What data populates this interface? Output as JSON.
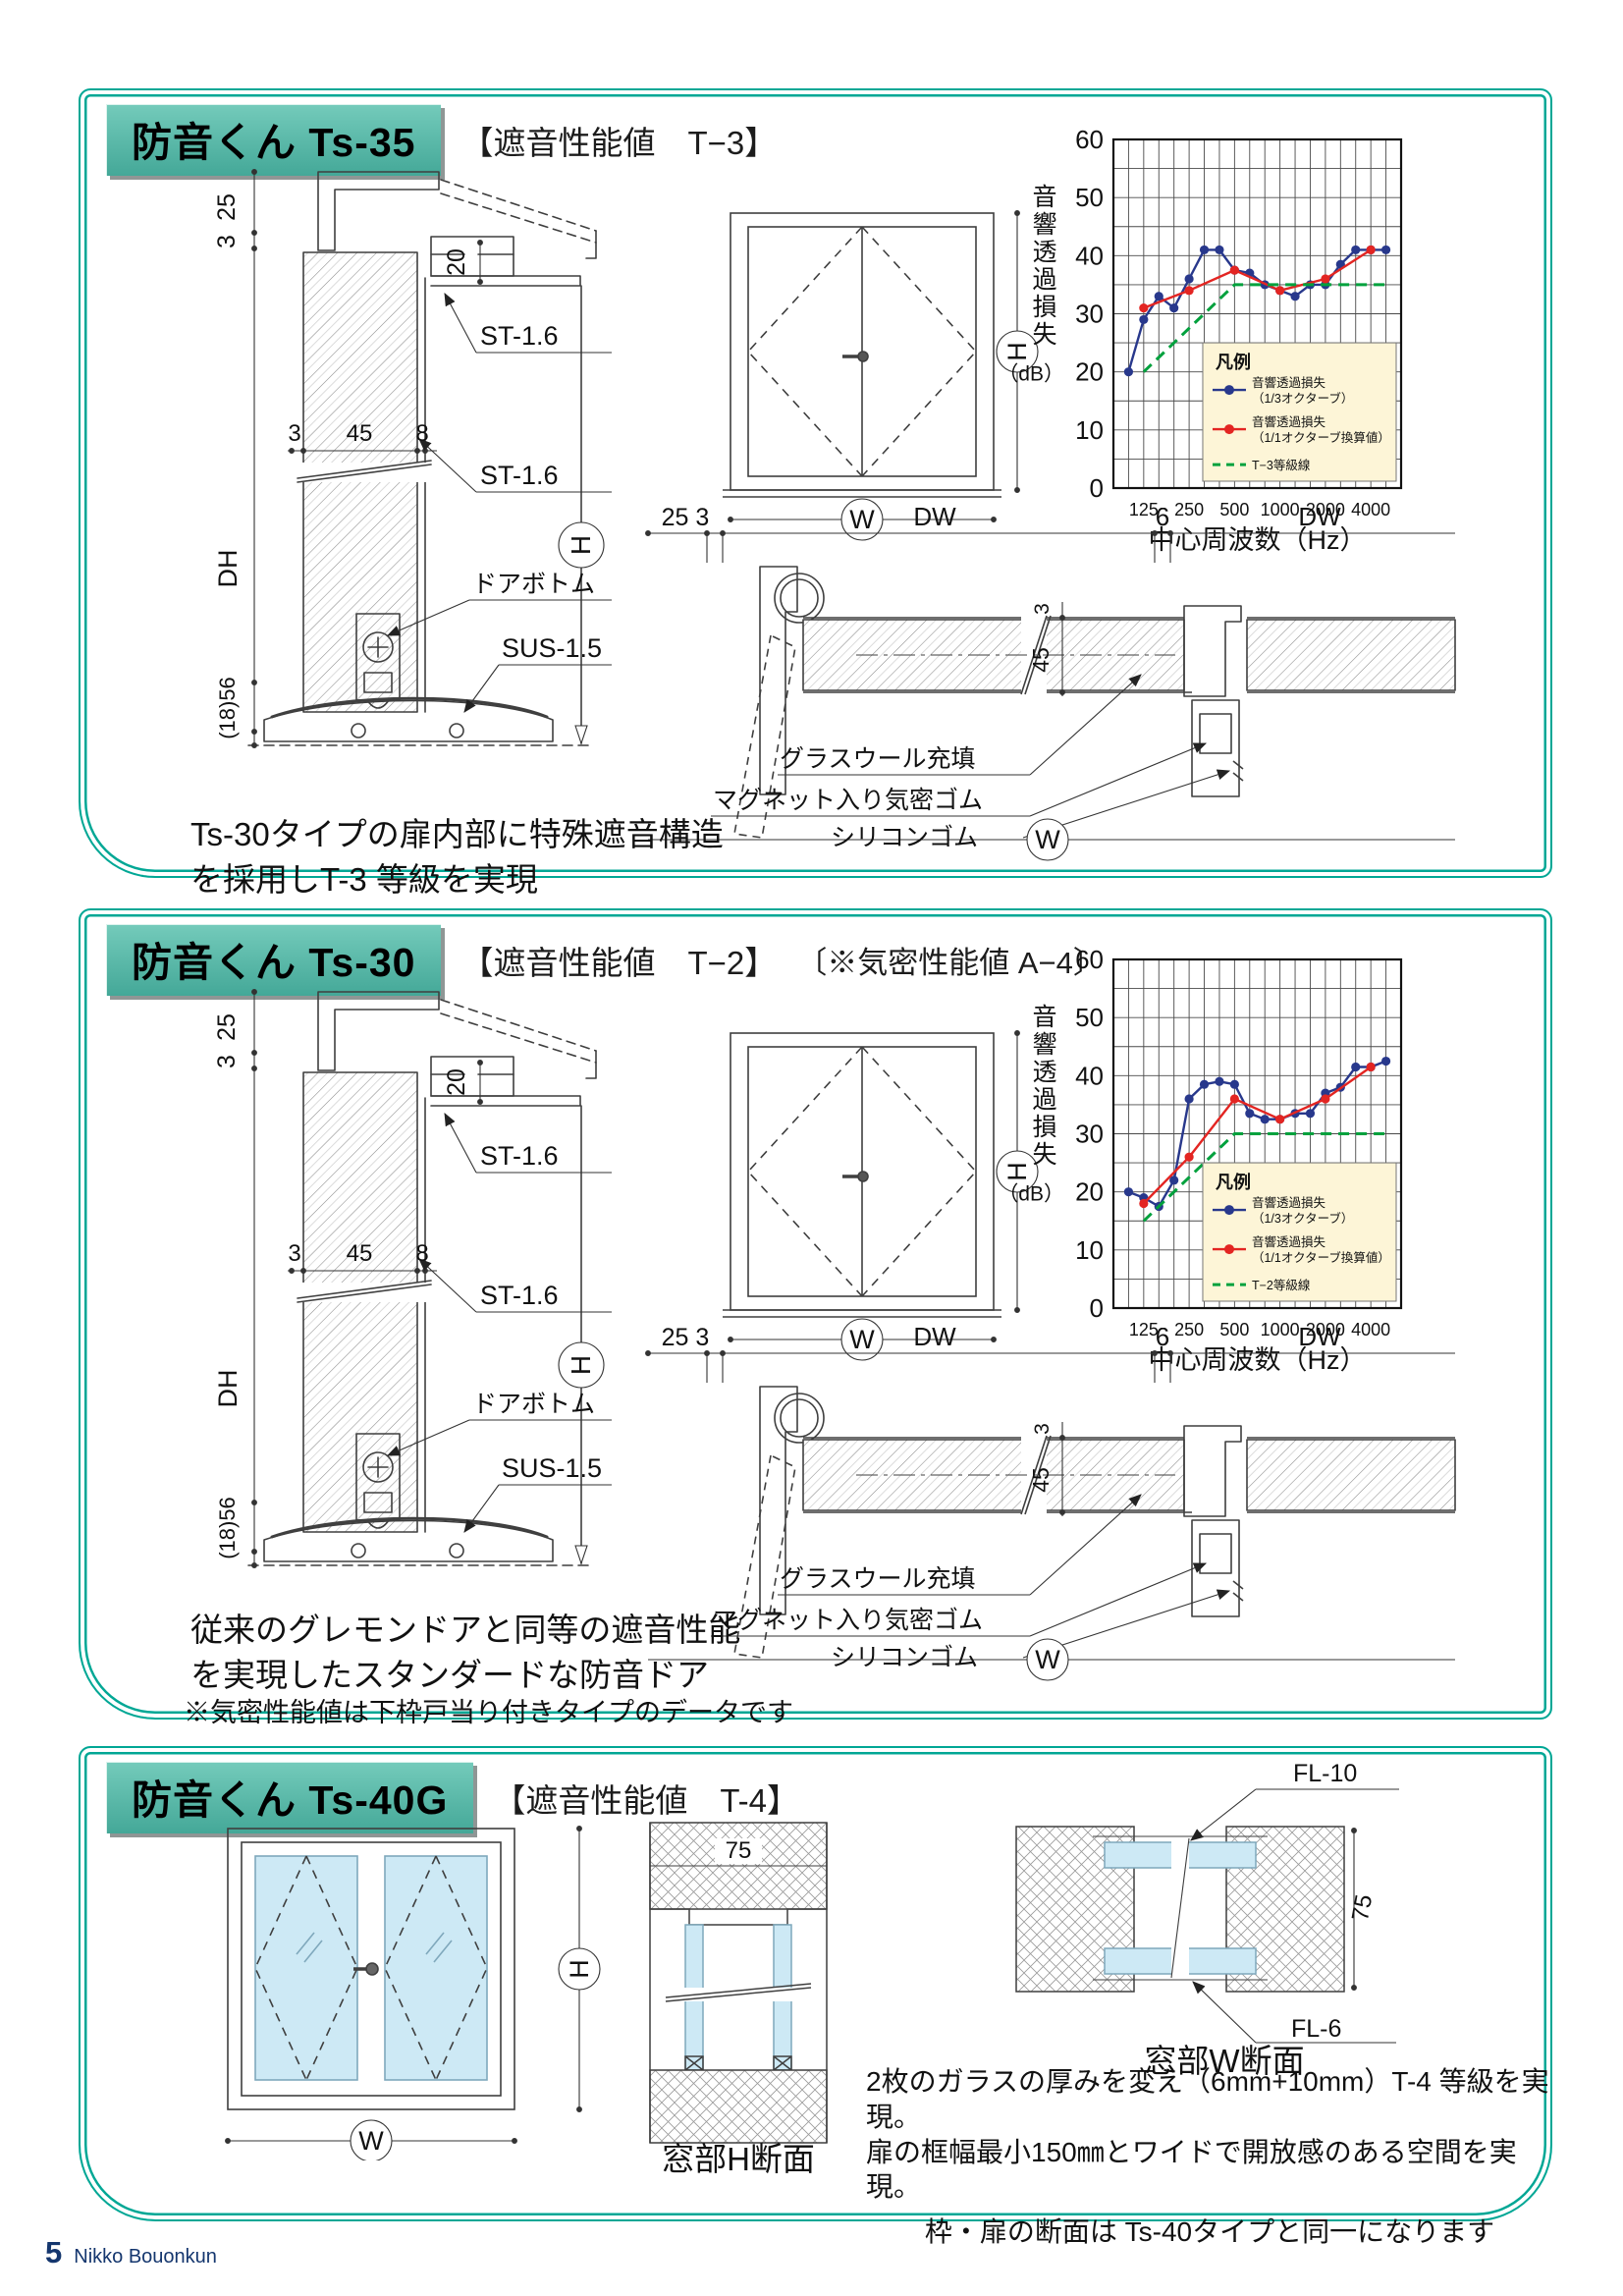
{
  "page": {
    "number": "5",
    "brand": "Nikko Bouonkun"
  },
  "colors": {
    "teal_border": "#00a795",
    "header_top": "#74cbbb",
    "header_bottom": "#44a898",
    "header_shadow": "#8f9695",
    "blue": "#28388c",
    "red": "#e32522",
    "green": "#00a13d",
    "legend_bg": "#fdf5d7",
    "glass": "#cde9f5",
    "footer_navy": "#14366e"
  },
  "sections": {
    "ts35": {
      "title": "防音くん Ts-35",
      "subtitle": "【遮音性能値　T−3】",
      "caption1": "Ts-30タイプの扉内部に特殊遮音構造",
      "caption2": "を採用しT-3 等級を実現"
    },
    "ts30": {
      "title": "防音くん Ts-30",
      "subtitle": "【遮音性能値　T−2】",
      "subtitle2": "〔※気密性能値 A−4〕",
      "caption1": "従来のグレモンドアと同等の遮音性能",
      "caption2": "を実現したスタンダードな防音ドア",
      "note": "※気密性能値は下枠戸当り付きタイプのデータです"
    },
    "ts40g": {
      "title": "防音くん Ts-40G",
      "subtitle": "【遮音性能値　T-4】",
      "fl10": "FL-10",
      "fl6": "FL-6",
      "dim75": "75",
      "h_caption": "窓部H断面",
      "w_caption": "窓部W断面",
      "caption1": "2枚のガラスの厚みを変え（6mm+10mm）T-4 等級を実現。",
      "caption2": "扉の框幅最小150㎜とワイドで開放感のある空間を実現。",
      "caption3": "枠・扉の断面は Ts-40タイプと同一になります"
    }
  },
  "drawing": {
    "dim25": "25",
    "dim3": "3",
    "dim20": "20",
    "dim45": "45",
    "dim8": "8",
    "dh": "DH",
    "dim1856": "(18)56",
    "h": "H",
    "w": "W",
    "st16": "ST-1.6",
    "doorbottom": "ドアボトム",
    "sus15": "SUS-1.5",
    "hdim253": "25 3",
    "dw": "DW",
    "dim6": "6",
    "glasswool": "グラスウール充填",
    "magnet": "マグネット入り気密ゴム",
    "silicone": "シリコンゴム"
  },
  "chart_data": [
    {
      "type": "line",
      "xlabel": "中心周波数（Hz）",
      "ylabel_vertical": "音響透過損失",
      "ylabel_unit": "（dB）",
      "ylim": [
        0,
        60
      ],
      "ytick_step": 10,
      "grid_db_step": 5,
      "origin_label": "0",
      "freqs": [
        100,
        125,
        160,
        200,
        250,
        315,
        400,
        500,
        630,
        800,
        1000,
        1250,
        1600,
        2000,
        2500,
        3150,
        4000,
        5000
      ],
      "xticks": [
        125,
        250,
        500,
        1000,
        2000,
        4000
      ],
      "legend_title": "凡例",
      "legend_position": "lower right inside",
      "grid": true,
      "series": [
        {
          "id": "third-octave",
          "color_key": "blue",
          "dashed": false,
          "legend": [
            "音響透過損失",
            "（1/3オクターブ）"
          ],
          "points": [
            [
              100,
              20
            ],
            [
              125,
              29
            ],
            [
              160,
              33
            ],
            [
              200,
              31
            ],
            [
              250,
              36
            ],
            [
              315,
              41
            ],
            [
              400,
              41
            ],
            [
              500,
              37.5
            ],
            [
              630,
              37
            ],
            [
              800,
              35
            ],
            [
              1000,
              34
            ],
            [
              1250,
              33
            ],
            [
              1600,
              35
            ],
            [
              2000,
              35
            ],
            [
              2500,
              38.5
            ],
            [
              3150,
              41
            ],
            [
              4000,
              41
            ],
            [
              5000,
              41
            ]
          ]
        },
        {
          "id": "full-octave",
          "color_key": "red",
          "dashed": false,
          "legend": [
            "音響透過損失",
            "（1/1オクターブ換算値）"
          ],
          "points": [
            [
              125,
              31
            ],
            [
              250,
              34
            ],
            [
              500,
              37.5
            ],
            [
              1000,
              34
            ],
            [
              2000,
              36
            ],
            [
              4000,
              41
            ]
          ]
        },
        {
          "id": "grade-line",
          "color_key": "green",
          "dashed": true,
          "legend": [
            "T−3等級線"
          ],
          "points": [
            [
              125,
              20
            ],
            [
              500,
              35
            ],
            [
              5000,
              35
            ]
          ]
        }
      ]
    },
    {
      "type": "line",
      "xlabel": "中心周波数（Hz）",
      "ylabel_vertical": "音響透過損失",
      "ylabel_unit": "（dB）",
      "ylim": [
        0,
        60
      ],
      "ytick_step": 10,
      "grid_db_step": 5,
      "origin_label": "0",
      "freqs": [
        100,
        125,
        160,
        200,
        250,
        315,
        400,
        500,
        630,
        800,
        1000,
        1250,
        1600,
        2000,
        2500,
        3150,
        4000,
        5000
      ],
      "xticks": [
        125,
        250,
        500,
        1000,
        2000,
        4000
      ],
      "legend_title": "凡例",
      "legend_position": "lower right inside",
      "grid": true,
      "series": [
        {
          "id": "third-octave",
          "color_key": "blue",
          "dashed": false,
          "legend": [
            "音響透過損失",
            "（1/3オクターブ）"
          ],
          "points": [
            [
              100,
              20
            ],
            [
              125,
              19
            ],
            [
              160,
              17.5
            ],
            [
              200,
              22
            ],
            [
              250,
              36
            ],
            [
              315,
              38.5
            ],
            [
              400,
              39
            ],
            [
              500,
              38.5
            ],
            [
              630,
              33.5
            ],
            [
              800,
              32.5
            ],
            [
              1000,
              32.5
            ],
            [
              1250,
              33.5
            ],
            [
              1600,
              33.5
            ],
            [
              2000,
              37
            ],
            [
              2500,
              38
            ],
            [
              3150,
              41.5
            ],
            [
              4000,
              41.5
            ],
            [
              5000,
              42.5
            ]
          ]
        },
        {
          "id": "full-octave",
          "color_key": "red",
          "dashed": false,
          "legend": [
            "音響透過損失",
            "（1/1オクターブ換算値）"
          ],
          "points": [
            [
              125,
              18
            ],
            [
              250,
              26
            ],
            [
              500,
              36
            ],
            [
              1000,
              32.5
            ],
            [
              2000,
              36
            ],
            [
              4000,
              41.5
            ]
          ]
        },
        {
          "id": "grade-line",
          "color_key": "green",
          "dashed": true,
          "legend": [
            "T−2等級線"
          ],
          "points": [
            [
              125,
              15
            ],
            [
              500,
              30
            ],
            [
              5000,
              30
            ]
          ]
        }
      ]
    }
  ]
}
